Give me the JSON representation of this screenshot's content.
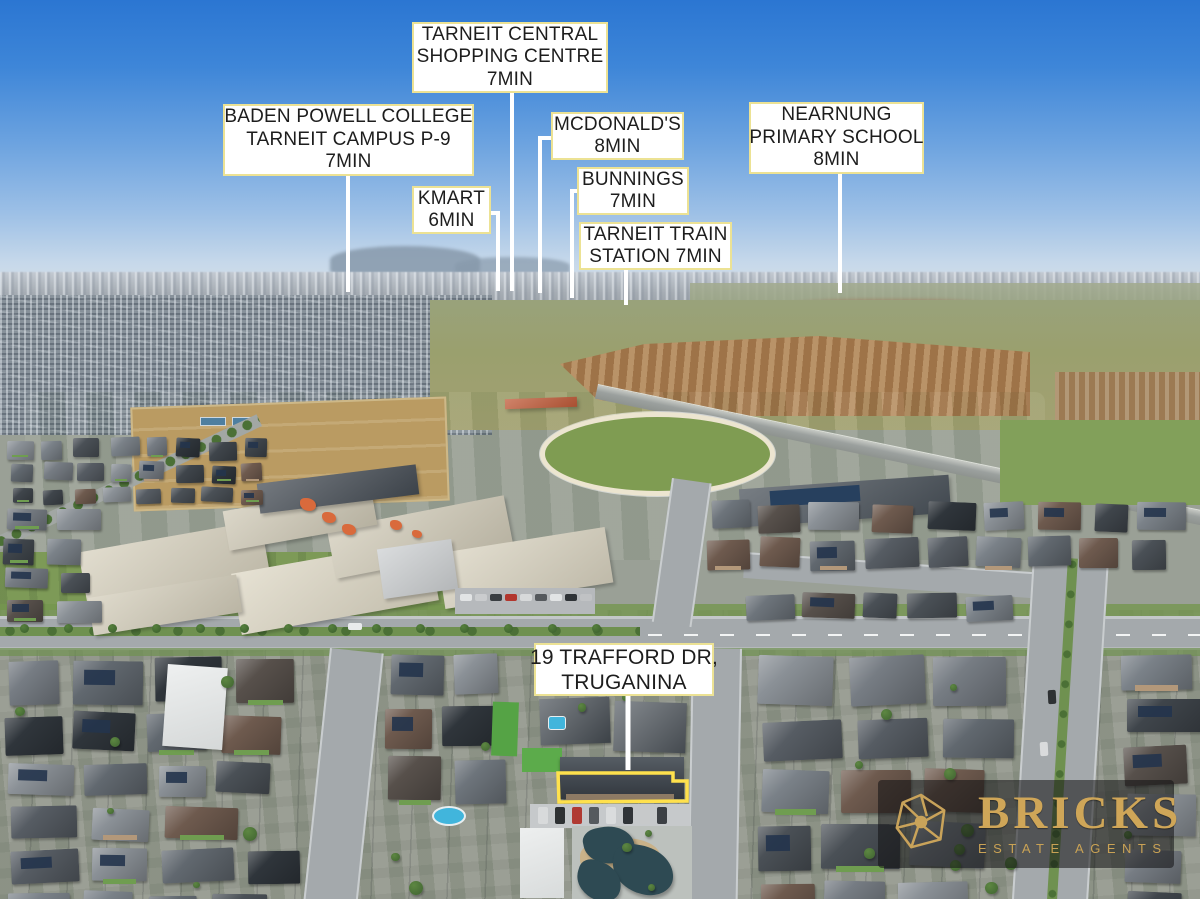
{
  "scene_title": "Aerial drone photo of Truganina / Tarneit suburb with location callouts",
  "colors": {
    "label_background": "#ffffff",
    "label_border": "#ece294",
    "label_text": "#1d1d1d",
    "leader_line": "#ffffff",
    "property_outline": "#ffe14d",
    "logo_gold": "#cfa658",
    "logo_background": "rgba(16,16,18,0.55)",
    "sky_top": "#2b76d2",
    "grass": "#7d9a55"
  },
  "labels": [
    {
      "id": "tarneit-central-shopping-centre",
      "lines": [
        "TARNEIT CENTRAL",
        "SHOPPING CENTRE",
        "7MIN"
      ],
      "box": {
        "x": 412,
        "y": 22,
        "w": 196,
        "h": 71
      },
      "leader": [
        [
          512,
          93
        ],
        [
          512,
          291
        ]
      ]
    },
    {
      "id": "baden-powell-college",
      "lines": [
        "BADEN POWELL COLLEGE",
        "TARNEIT CAMPUS P-9",
        "7MIN"
      ],
      "box": {
        "x": 223,
        "y": 104,
        "w": 251,
        "h": 72
      },
      "leader": [
        [
          348,
          176
        ],
        [
          348,
          292
        ]
      ]
    },
    {
      "id": "mcdonalds",
      "lines": [
        "MCDONALD'S",
        "8MIN"
      ],
      "box": {
        "x": 551,
        "y": 112,
        "w": 133,
        "h": 48
      },
      "leader": [
        [
          551,
          138
        ],
        [
          540,
          138
        ],
        [
          540,
          293
        ]
      ]
    },
    {
      "id": "kmart",
      "lines": [
        "KMART",
        "6MIN"
      ],
      "box": {
        "x": 412,
        "y": 186,
        "w": 79,
        "h": 48
      },
      "leader": [
        [
          491,
          213
        ],
        [
          498,
          213
        ],
        [
          498,
          291
        ]
      ]
    },
    {
      "id": "bunnings",
      "lines": [
        "BUNNINGS",
        "7MIN"
      ],
      "box": {
        "x": 577,
        "y": 167,
        "w": 112,
        "h": 48
      },
      "leader": [
        [
          577,
          191
        ],
        [
          572,
          191
        ],
        [
          572,
          298
        ]
      ]
    },
    {
      "id": "tarneit-train-station",
      "lines": [
        "TARNEIT TRAIN",
        "STATION 7MIN"
      ],
      "box": {
        "x": 579,
        "y": 222,
        "w": 153,
        "h": 48
      },
      "leader": [
        [
          626,
          270
        ],
        [
          626,
          305
        ]
      ]
    },
    {
      "id": "nearnung-primary-school",
      "lines": [
        "NEARNUNG",
        "PRIMARY SCHOOL",
        "8MIN"
      ],
      "box": {
        "x": 749,
        "y": 102,
        "w": 175,
        "h": 72
      },
      "leader": [
        [
          840,
          174
        ],
        [
          840,
          293
        ]
      ]
    },
    {
      "id": "property-address",
      "lines": [
        "19 TRAFFORD DR,",
        "TRUGANINA"
      ],
      "large": true,
      "box": {
        "x": 534,
        "y": 643,
        "w": 180,
        "h": 53
      },
      "leader": [
        [
          628,
          696
        ],
        [
          628,
          770
        ]
      ]
    }
  ],
  "property_outline": {
    "points": [
      [
        558,
        773
      ],
      [
        673,
        773
      ],
      [
        673,
        781
      ],
      [
        687,
        781
      ],
      [
        687,
        801
      ],
      [
        559,
        802
      ]
    ]
  },
  "logo": {
    "name": "BRICKS",
    "tagline": "ESTATE AGENTS"
  }
}
